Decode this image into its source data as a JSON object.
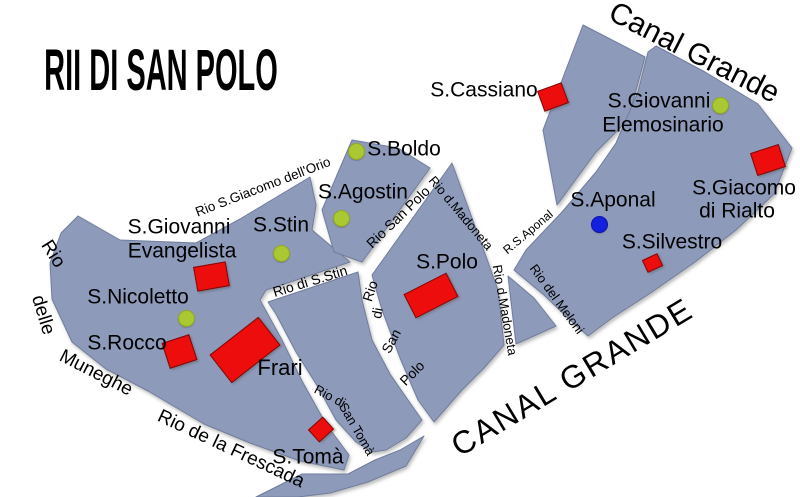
{
  "map": {
    "title": "RII DI SAN POLO",
    "colors": {
      "background": "#ffffff",
      "island_fill": "#8e9aba",
      "island_edge": "#6f7d9d",
      "church_red": "#ee0d0d",
      "church_edge": "#7a0b0b",
      "green_dot": "#aac832",
      "green_dot_edge": "#8fa822",
      "blue_dot": "#1420e0",
      "blue_dot_edge": "#0c14a8",
      "label_color": "#000000"
    },
    "islands": [
      {
        "name": "island-frari-west",
        "points": "78,216 120,240 196,243 240,219 310,177 316,205 312,230 350,262 266,290 260,300 282,340 302,381 326,424 349,455 344,470 300,461 250,443 204,424 148,391 106,369 72,342 52,299 50,263 61,233"
      },
      {
        "name": "island-s-agostin",
        "points": "352,140 398,148 430,168 362,262 334,252 322,210"
      },
      {
        "name": "island-san-toma-wedge",
        "points": "358,272 362,300 372,340 390,374 408,400 422,420 406,438 386,450 372,452 356,442 336,420 318,387 296,352 276,314 268,302"
      },
      {
        "name": "island-s-polo",
        "points": "452,163 488,262 498,290 504,345 484,368 462,390 434,422 418,400 400,358 382,310 372,275"
      },
      {
        "name": "island-s-cassiano",
        "points": "583,25 645,57 628,120 596,152 557,205 543,130"
      },
      {
        "name": "island-rialto-aponal",
        "points": "656,46 705,72 758,104 792,148 774,194 736,230 695,262 652,292 612,318 588,336 570,320 544,295 514,270 526,250 562,212 596,172 616,143 638,92 648,52"
      },
      {
        "name": "island-meloni-sliver",
        "points": "508,276 516,344 556,326 534,298"
      },
      {
        "name": "island-frescada-sliver",
        "points": "256,497 302,474 348,474 375,460 400,450 424,436 406,466 368,482 330,493 298,497"
      }
    ],
    "labels": [
      {
        "name": "map-title",
        "text": "RII DI SAN POLO",
        "x": 161,
        "y": 71,
        "size": 58,
        "rot": 0,
        "weight": 700,
        "sx": 0.5
      },
      {
        "name": "canal-grande-top-label",
        "text": "Canal Grande",
        "x": 694,
        "y": 53,
        "size": 30,
        "rot": 27,
        "weight": 400
      },
      {
        "name": "canal-grande-bottom-label",
        "text": "CANAL GRANDE",
        "x": 572,
        "y": 377,
        "size": 32,
        "rot": -31,
        "weight": 400,
        "ls": 2
      },
      {
        "name": "label-s-cassiano",
        "text": "S.Cassiano",
        "x": 484,
        "y": 90,
        "size": 21,
        "rot": 0,
        "weight": 400
      },
      {
        "name": "label-s-giovanni-elemosinario-1",
        "text": "S.Giovanni",
        "x": 659,
        "y": 101,
        "size": 21,
        "rot": 0,
        "weight": 400
      },
      {
        "name": "label-s-giovanni-elemosinario-2",
        "text": "Elemosinario",
        "x": 663,
        "y": 125,
        "size": 21,
        "rot": 0,
        "weight": 400
      },
      {
        "name": "label-s-boldo",
        "text": "S.Boldo",
        "x": 404,
        "y": 149,
        "size": 21,
        "rot": 0,
        "weight": 400
      },
      {
        "name": "label-s-agostin",
        "text": "S.Agostin",
        "x": 363,
        "y": 192,
        "size": 21,
        "rot": 0,
        "weight": 400
      },
      {
        "name": "label-s-giacomo-1",
        "text": "S.Giacomo",
        "x": 744,
        "y": 188,
        "size": 21,
        "rot": 0,
        "weight": 400
      },
      {
        "name": "label-s-giacomo-2",
        "text": "di Rialto",
        "x": 737,
        "y": 211,
        "size": 21,
        "rot": 0,
        "weight": 400
      },
      {
        "name": "label-s-aponal",
        "text": "S.Aponal",
        "x": 613,
        "y": 200,
        "size": 21,
        "rot": 0,
        "weight": 400
      },
      {
        "name": "label-s-silvestro",
        "text": "S.Silvestro",
        "x": 672,
        "y": 242,
        "size": 21,
        "rot": 0,
        "weight": 400
      },
      {
        "name": "label-s-giovanni-evangelista-1",
        "text": "S.Giovanni",
        "x": 179,
        "y": 227,
        "size": 21,
        "rot": 0,
        "weight": 400
      },
      {
        "name": "label-s-giovanni-evangelista-2",
        "text": "Evangelista",
        "x": 182,
        "y": 251,
        "size": 21,
        "rot": 0,
        "weight": 400
      },
      {
        "name": "label-s-stin",
        "text": "S.Stin",
        "x": 281,
        "y": 225,
        "size": 21,
        "rot": 0,
        "weight": 400
      },
      {
        "name": "label-s-nicoletto",
        "text": "S.Nicoletto",
        "x": 138,
        "y": 297,
        "size": 21,
        "rot": 0,
        "weight": 400
      },
      {
        "name": "label-s-rocco",
        "text": "S.Rocco",
        "x": 127,
        "y": 343,
        "size": 21,
        "rot": 0,
        "weight": 400
      },
      {
        "name": "label-frari",
        "text": "Frari",
        "x": 280,
        "y": 368,
        "size": 22,
        "rot": 0,
        "weight": 400
      },
      {
        "name": "label-s-polo",
        "text": "S.Polo",
        "x": 447,
        "y": 262,
        "size": 21,
        "rot": 0,
        "weight": 400
      },
      {
        "name": "label-s-toma",
        "text": "S.Tomà",
        "x": 308,
        "y": 457,
        "size": 21,
        "rot": 0,
        "weight": 400
      },
      {
        "name": "canal-label-rio-s-giacomo-dellorio",
        "text": "Rio S.Giacomo dell'Orio",
        "x": 263,
        "y": 187,
        "size": 13.5,
        "rot": -21,
        "weight": 400
      },
      {
        "name": "canal-label-rio-san-polo",
        "text": "Rio San Polo",
        "x": 398,
        "y": 217,
        "size": 14,
        "rot": -44,
        "weight": 400
      },
      {
        "name": "canal-label-rio-d-madoneta-upper",
        "text": "Rio d.Madoneta",
        "x": 461,
        "y": 213,
        "size": 13,
        "rot": 50,
        "weight": 400
      },
      {
        "name": "canal-label-r-s-aponal",
        "text": "R.S.Aponal",
        "x": 528,
        "y": 232,
        "size": 12,
        "rot": -40,
        "weight": 400
      },
      {
        "name": "canal-label-rio-di-s-stin",
        "text": "Rio di S.Stin",
        "x": 310,
        "y": 281,
        "size": 14,
        "rot": -17,
        "weight": 400
      },
      {
        "name": "canal-label-rio-di-san-polo-1",
        "text": "Rio",
        "x": 370,
        "y": 291,
        "size": 14,
        "rot": -72,
        "weight": 400
      },
      {
        "name": "canal-label-rio-di-san-polo-2",
        "text": "di",
        "x": 377,
        "y": 313,
        "size": 14,
        "rot": -80,
        "weight": 400
      },
      {
        "name": "canal-label-rio-di-san-polo-3",
        "text": "San",
        "x": 391,
        "y": 341,
        "size": 14,
        "rot": -62,
        "weight": 400
      },
      {
        "name": "canal-label-rio-di-san-polo-4",
        "text": "Polo",
        "x": 412,
        "y": 373,
        "size": 14,
        "rot": -45,
        "weight": 400
      },
      {
        "name": "canal-label-rio-d-madoneta-lower",
        "text": "Rio d.Madoneta",
        "x": 505,
        "y": 310,
        "size": 13,
        "rot": 80,
        "weight": 400
      },
      {
        "name": "canal-label-rio-del-meloni",
        "text": "Rio del Meloni",
        "x": 557,
        "y": 299,
        "size": 13,
        "rot": 54,
        "weight": 400
      },
      {
        "name": "canal-label-rio-di-san-toma-1",
        "text": "Rio di",
        "x": 330,
        "y": 396,
        "size": 13,
        "rot": 28,
        "weight": 400
      },
      {
        "name": "canal-label-rio-di-san-toma-2",
        "text": "San Tomà",
        "x": 357,
        "y": 429,
        "size": 13,
        "rot": 60,
        "weight": 400
      },
      {
        "name": "canal-label-rio-de-la-frescada",
        "text": "Rio de la Frescada",
        "x": 231,
        "y": 449,
        "size": 19,
        "rot": 25,
        "weight": 400
      },
      {
        "name": "canal-label-rio-delle-muneghe-1",
        "text": "Rio",
        "x": 53,
        "y": 254,
        "size": 19,
        "rot": 58,
        "weight": 400
      },
      {
        "name": "canal-label-rio-delle-muneghe-2",
        "text": "delle",
        "x": 43,
        "y": 315,
        "size": 19,
        "rot": 73,
        "weight": 400
      },
      {
        "name": "canal-label-rio-delle-muneghe-3",
        "text": "Muneghe",
        "x": 96,
        "y": 373,
        "size": 19,
        "rot": 27,
        "weight": 400
      }
    ],
    "churches": [
      {
        "name": "church-marker-s-cassiano",
        "x": 553,
        "y": 97,
        "w": 26,
        "h": 22,
        "rot": -20
      },
      {
        "name": "church-marker-s-giacomo",
        "x": 768,
        "y": 160,
        "w": 30,
        "h": 24,
        "rot": -18
      },
      {
        "name": "church-marker-s-silvestro",
        "x": 652,
        "y": 263,
        "w": 17,
        "h": 14,
        "rot": -25
      },
      {
        "name": "church-marker-s-polo",
        "x": 431,
        "y": 295,
        "w": 48,
        "h": 27,
        "rot": -27
      },
      {
        "name": "church-marker-evangelista",
        "x": 211,
        "y": 276,
        "w": 33,
        "h": 25,
        "rot": -10
      },
      {
        "name": "church-marker-s-rocco",
        "x": 179,
        "y": 351,
        "w": 29,
        "h": 27,
        "rot": -18
      },
      {
        "name": "church-marker-frari",
        "x": 245,
        "y": 350,
        "w": 62,
        "h": 36,
        "rot": -38
      },
      {
        "name": "church-marker-s-toma",
        "x": 321,
        "y": 429,
        "w": 20,
        "h": 17,
        "rot": -42
      }
    ],
    "green_dots": [
      {
        "name": "green-dot-s-boldo",
        "x": 356,
        "y": 151,
        "d": 17
      },
      {
        "name": "green-dot-s-agostin",
        "x": 341,
        "y": 218,
        "d": 17
      },
      {
        "name": "green-dot-s-stin",
        "x": 281,
        "y": 253,
        "d": 17
      },
      {
        "name": "green-dot-s-nicoletto",
        "x": 186,
        "y": 318,
        "d": 17
      },
      {
        "name": "green-dot-elemosinario",
        "x": 720,
        "y": 105,
        "d": 17
      }
    ],
    "blue_dots": [
      {
        "name": "blue-dot-s-aponal",
        "x": 599,
        "y": 224,
        "d": 17
      }
    ]
  }
}
